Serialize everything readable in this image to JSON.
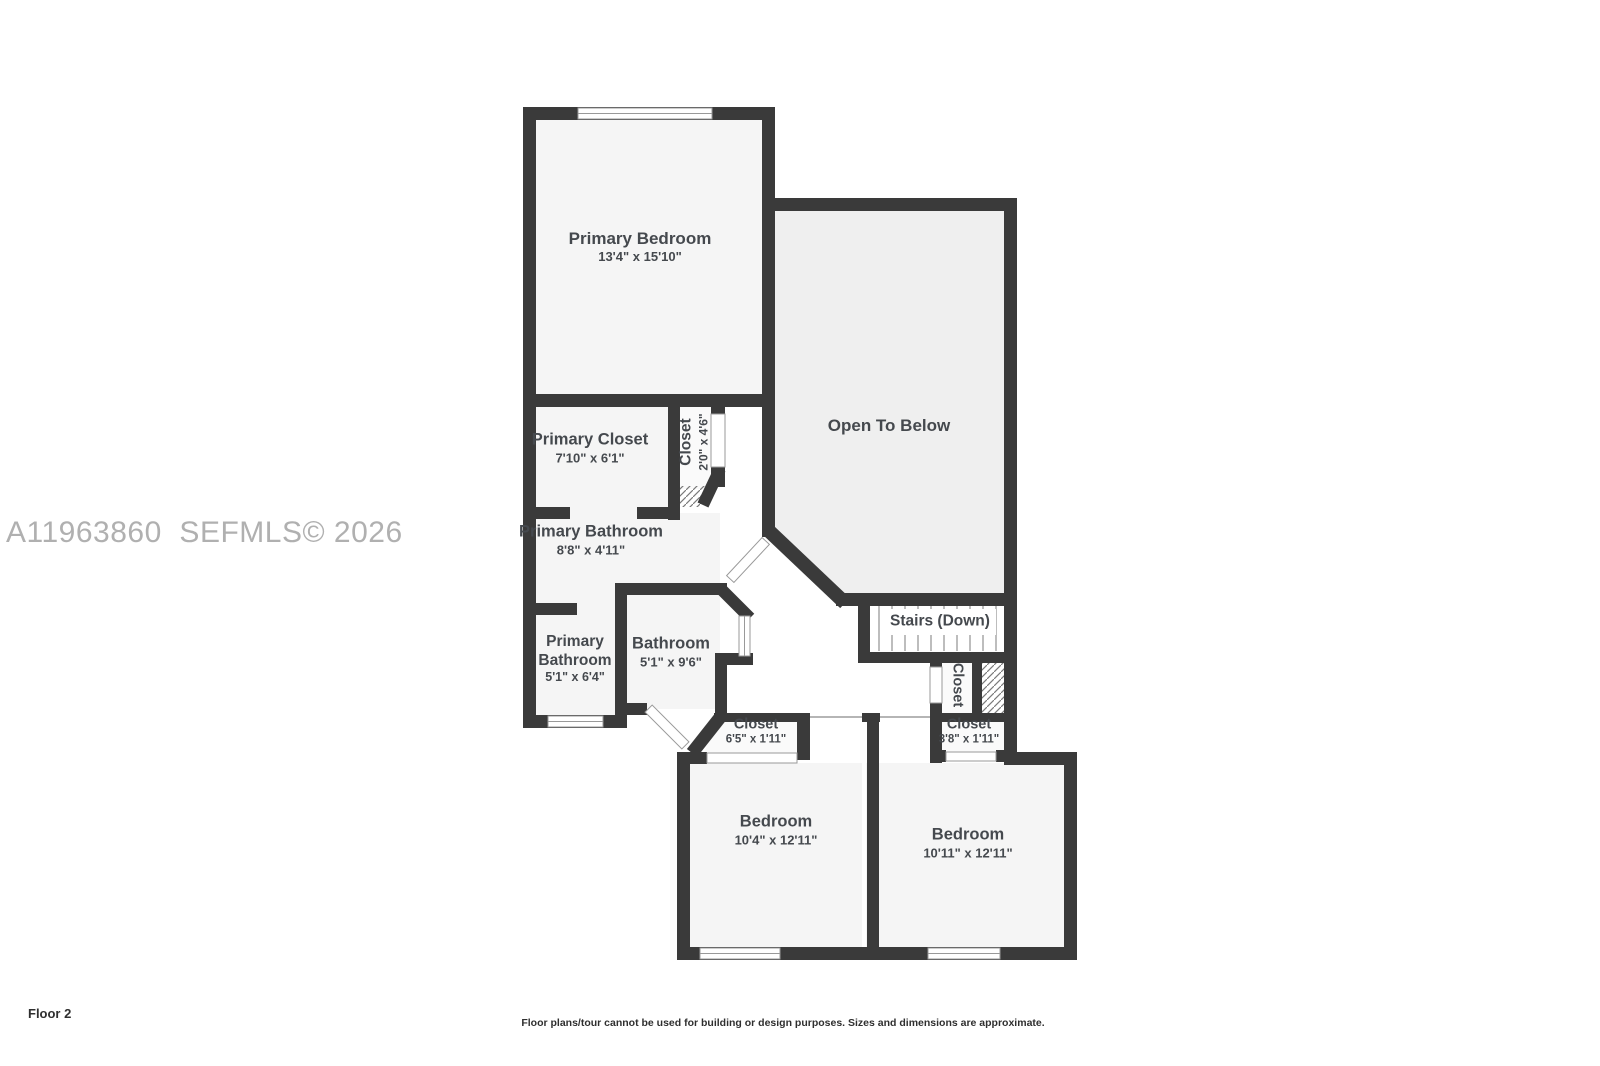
{
  "watermark": {
    "text": "A11963860  SEFMLS© 2026"
  },
  "plan": {
    "rooms": {
      "primary_bedroom": {
        "name": "Primary Bedroom",
        "dims": "13'4\" x 15'10\""
      },
      "open_to_below": {
        "name": "Open To Below"
      },
      "primary_closet": {
        "name": "Primary Closet",
        "dims": "7'10\" x 6'1\""
      },
      "closet_upper": {
        "name": "Closet",
        "dims": "2'0\" x 4'6\""
      },
      "primary_bathroom_upper": {
        "name": "Primary Bathroom",
        "dims": "8'8\" x 4'11\""
      },
      "primary_bathroom_lower": {
        "name": "Primary\nBathroom",
        "dims": "5'1\" x 6'4\""
      },
      "bathroom": {
        "name": "Bathroom",
        "dims": "5'1\" x 9'6\""
      },
      "stairs": {
        "name": "Stairs (Down)"
      },
      "closet_stairs": {
        "name": "Closet"
      },
      "closet_hall": {
        "name": "Closet",
        "dims": "6'5\" x 1'11\""
      },
      "closet_bedroom": {
        "name": "Closet",
        "dims": "3'8\" x 1'11\""
      },
      "bedroom_left": {
        "name": "Bedroom",
        "dims": "10'4\" x 12'11\""
      },
      "bedroom_right": {
        "name": "Bedroom",
        "dims": "10'11\" x 12'11\""
      }
    }
  },
  "footer": {
    "floor_label": "Floor 2",
    "disclaimer": "Floor plans/tour cannot be used for building or design purposes. Sizes and dimensions are approximate."
  },
  "colors": {
    "wall": "#3a3a3a",
    "room_fill": "#f5f5f5",
    "open_fill": "#efefef",
    "label_text": "#45494e",
    "watermark": "#b0b0b0"
  }
}
